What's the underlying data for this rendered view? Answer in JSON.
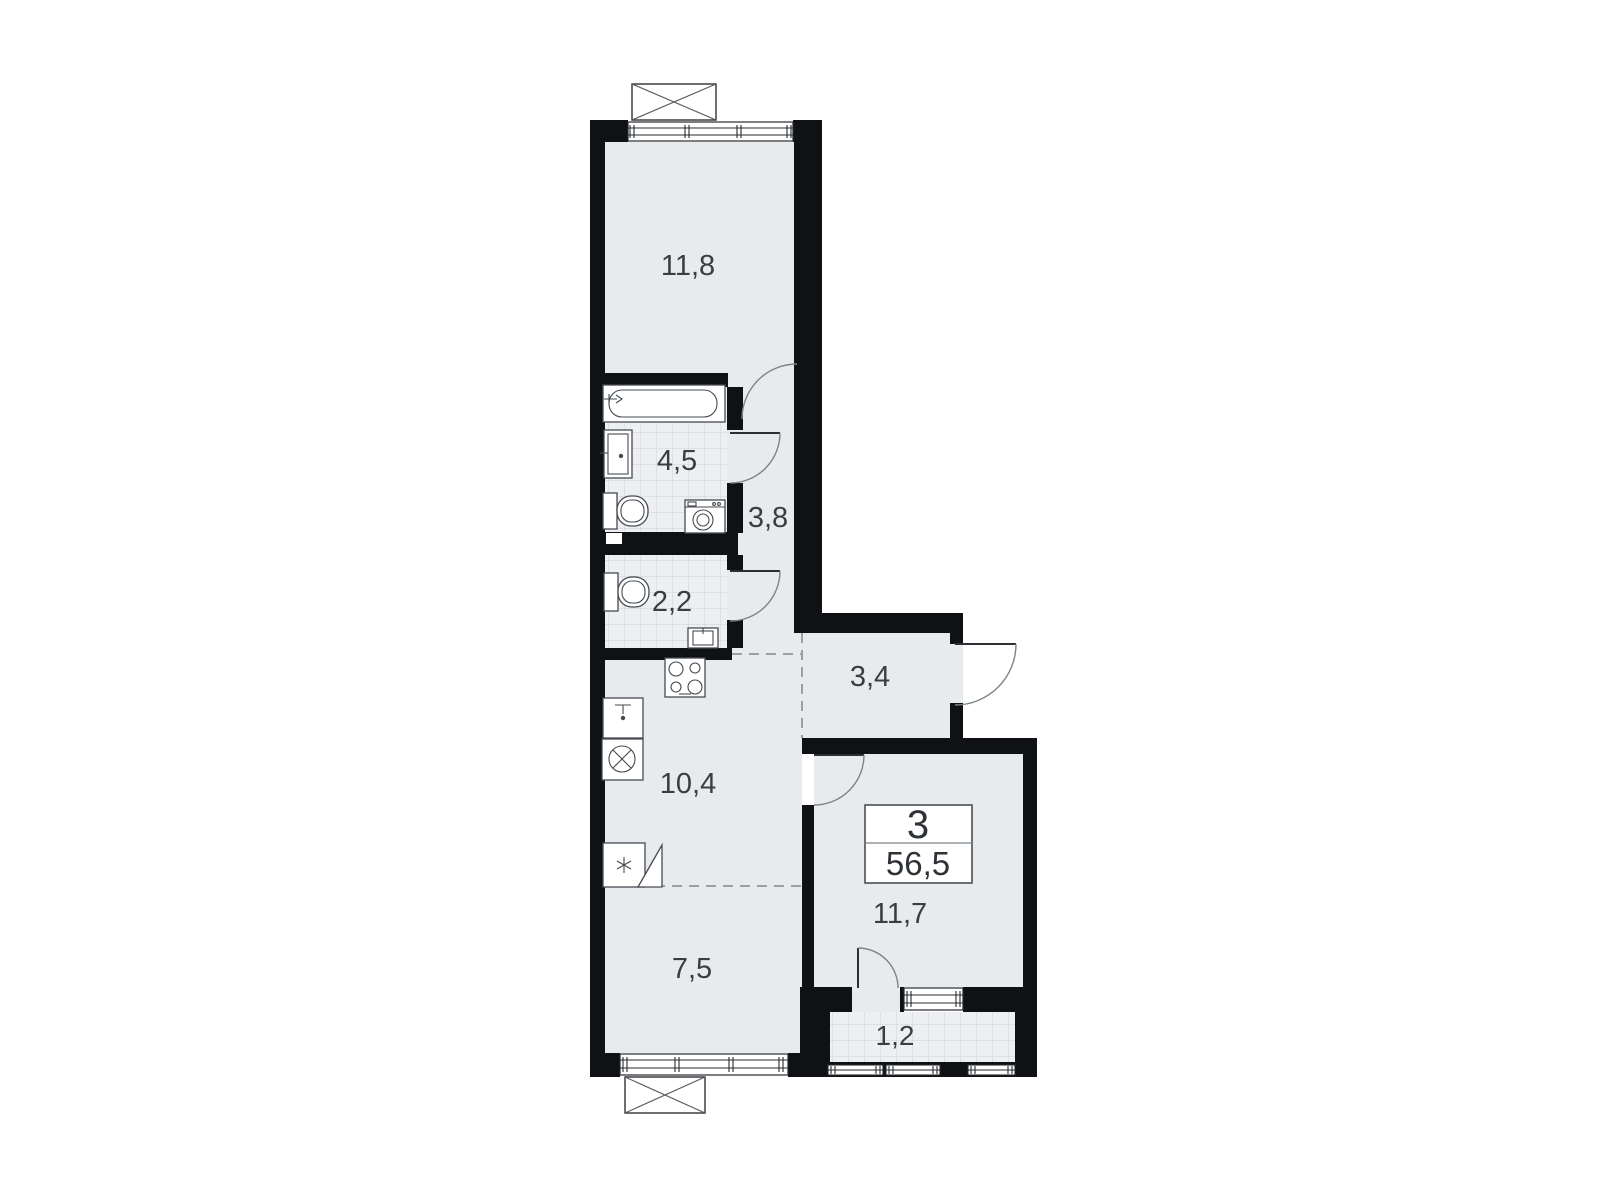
{
  "info_box": {
    "rooms_count": "3",
    "total_area": "56,5"
  },
  "room_labels": {
    "living": "11,8",
    "bathroom": "4,5",
    "hallway": "3,8",
    "wc": "2,2",
    "entry_hall": "3,4",
    "kitchen": "10,4",
    "room_small": "7,5",
    "bedroom": "11,7",
    "balcony": "1,2"
  },
  "colors": {
    "background": "#ffffff",
    "wall": "#101114",
    "floor": "#e8ebee",
    "tile_floor": "#edeff2",
    "tile_line": "#ced2d6",
    "label_text": "#3a3e42"
  },
  "fixtures": {
    "bathtub": "bathtub-icon",
    "washbasin": "washbasin-icon",
    "toilet_bath": "toilet-icon",
    "washing_machine_bath": "washing-machine-icon",
    "toilet_wc": "toilet-icon",
    "small_sink_wc": "small-sink-icon",
    "stove": "stove-icon",
    "kitchen_sink": "kitchen-sink-icon",
    "kitchen_washer": "washing-machine-icon",
    "fridge": "fridge-snowflake-icon"
  }
}
